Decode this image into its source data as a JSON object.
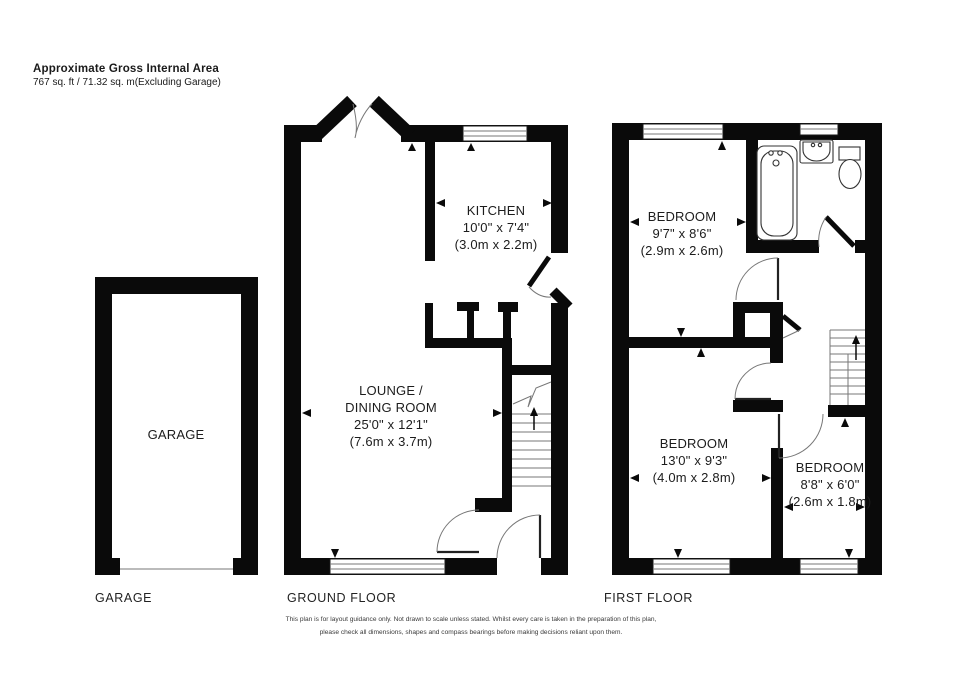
{
  "header": {
    "title": "Approximate Gross Internal Area",
    "subtitle": "767 sq. ft / 71.32 sq. m(Excluding Garage)"
  },
  "garage": {
    "room_label": "GARAGE",
    "floor_label": "GARAGE"
  },
  "ground_floor": {
    "floor_label": "GROUND FLOOR",
    "kitchen": {
      "name": "KITCHEN",
      "imperial": "10'0\" x 7'4\"",
      "metric": "(3.0m x 2.2m)"
    },
    "lounge": {
      "name_line1": "LOUNGE /",
      "name_line2": "DINING ROOM",
      "imperial": "25'0\" x 12'1\"",
      "metric": "(7.6m x 3.7m)"
    }
  },
  "first_floor": {
    "floor_label": "FIRST FLOOR",
    "bedroom1": {
      "name": "BEDROOM",
      "imperial": "9'7\" x 8'6\"",
      "metric": "(2.9m x 2.6m)"
    },
    "bedroom2": {
      "name": "BEDROOM",
      "imperial": "13'0\" x 9'3\"",
      "metric": "(4.0m x 2.8m)"
    },
    "bedroom3": {
      "name": "BEDROOM",
      "imperial": "8'8\" x 6'0\"",
      "metric": "(2.6m x 1.8m)"
    }
  },
  "disclaimer": {
    "line1": "This plan is for layout guidance only.  Not drawn to scale unless stated. Whilst every care is taken in the preparation of this plan,",
    "line2": "please check all dimensions, shapes and compass bearings before making decisions reliant upon them."
  },
  "colors": {
    "wall": "#0a0a0a",
    "thin_line": "#777777",
    "text": "#1c1c1c",
    "background": "#ffffff"
  }
}
